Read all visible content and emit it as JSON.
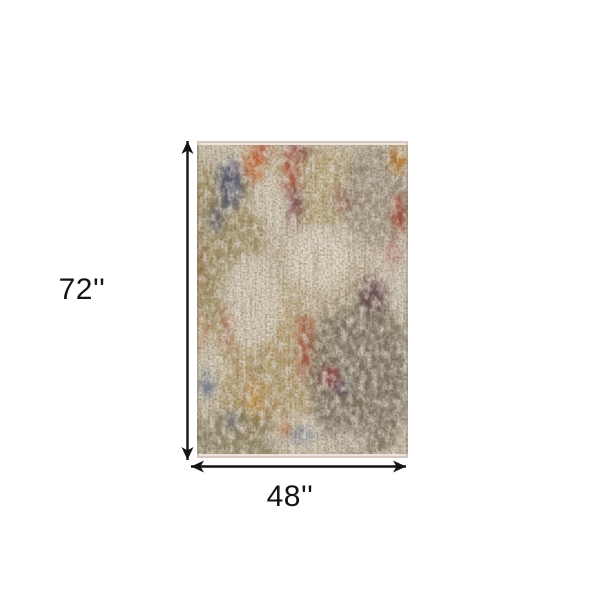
{
  "diagram": {
    "type": "product-dimension-diagram",
    "height_label": "72''",
    "width_label": "48''",
    "arrow_color": "#141414",
    "label_color": "#141414",
    "background_color": "#ffffff"
  },
  "rug": {
    "description": "abstract-distressed-multicolor-area-rug",
    "base_color": "#cfc3ad",
    "fringe_color": "#efe2dc",
    "edge_shade_color": "#5a503c",
    "blobs": [
      {
        "x": 28,
        "y": 100,
        "rx": 40,
        "ry": 95,
        "c": "#9c8a58",
        "o": 0.75
      },
      {
        "x": 70,
        "y": 215,
        "rx": 55,
        "ry": 85,
        "c": "#b89c68",
        "o": 0.75
      },
      {
        "x": 118,
        "y": 45,
        "rx": 50,
        "ry": 40,
        "c": "#bda775",
        "o": 0.7
      },
      {
        "x": 162,
        "y": 235,
        "rx": 50,
        "ry": 90,
        "c": "#7a7160",
        "o": 0.85
      },
      {
        "x": 182,
        "y": 55,
        "rx": 38,
        "ry": 50,
        "c": "#94897a",
        "o": 0.65
      },
      {
        "x": 40,
        "y": 298,
        "rx": 48,
        "ry": 28,
        "c": "#867a58",
        "o": 0.7
      },
      {
        "x": 120,
        "y": 135,
        "rx": 48,
        "ry": 42,
        "c": "#cabb9b",
        "o": 0.75
      },
      {
        "x": 55,
        "y": 160,
        "rx": 30,
        "ry": 48,
        "c": "#e3dccc",
        "o": 0.85
      },
      {
        "x": 122,
        "y": 118,
        "rx": 32,
        "ry": 30,
        "c": "#e6dfd0",
        "o": 0.85
      },
      {
        "x": 34,
        "y": 18,
        "rx": 24,
        "ry": 15,
        "c": "#ddd6c6",
        "o": 0.85
      },
      {
        "x": 76,
        "y": 58,
        "rx": 24,
        "ry": 26,
        "c": "#ded7c5",
        "o": 0.8
      },
      {
        "x": 100,
        "y": 292,
        "rx": 28,
        "ry": 18,
        "c": "#ded7c7",
        "o": 0.8
      },
      {
        "x": 201,
        "y": 135,
        "rx": 16,
        "ry": 38,
        "c": "#d9d3c5",
        "o": 0.8
      },
      {
        "x": 150,
        "y": 303,
        "rx": 24,
        "ry": 13,
        "c": "#d9d2c2",
        "o": 0.75
      },
      {
        "x": 14,
        "y": 225,
        "rx": 14,
        "ry": 30,
        "c": "#dcd5c5",
        "o": 0.7
      },
      {
        "x": 33,
        "y": 44,
        "rx": 13,
        "ry": 26,
        "c": "#46527a",
        "o": 0.8
      },
      {
        "x": 19,
        "y": 78,
        "rx": 8,
        "ry": 14,
        "c": "#3e4b73",
        "o": 0.65
      },
      {
        "x": 56,
        "y": 24,
        "rx": 10,
        "ry": 18,
        "c": "#cf5a1e",
        "o": 0.85
      },
      {
        "x": 67,
        "y": 10,
        "rx": 7,
        "ry": 9,
        "c": "#c2401f",
        "o": 0.8
      },
      {
        "x": 94,
        "y": 30,
        "rx": 7,
        "ry": 25,
        "c": "#a93326",
        "o": 0.8
      },
      {
        "x": 98,
        "y": 63,
        "rx": 8,
        "ry": 19,
        "c": "#6d3040",
        "o": 0.75
      },
      {
        "x": 104,
        "y": 11,
        "rx": 9,
        "ry": 8,
        "c": "#7c2e33",
        "o": 0.7
      },
      {
        "x": 146,
        "y": 58,
        "rx": 6,
        "ry": 11,
        "c": "#7e2d34",
        "o": 0.65
      },
      {
        "x": 201,
        "y": 20,
        "rx": 8,
        "ry": 14,
        "c": "#cc7d20",
        "o": 0.85
      },
      {
        "x": 202,
        "y": 73,
        "rx": 8,
        "ry": 20,
        "c": "#ab3224",
        "o": 0.8
      },
      {
        "x": 196,
        "y": 112,
        "rx": 6,
        "ry": 13,
        "c": "#b0392a",
        "o": 0.55
      },
      {
        "x": 176,
        "y": 152,
        "rx": 15,
        "ry": 18,
        "c": "#5c3346",
        "o": 0.7
      },
      {
        "x": 108,
        "y": 205,
        "rx": 6,
        "ry": 33,
        "c": "#a93224",
        "o": 0.75
      },
      {
        "x": 30,
        "y": 185,
        "rx": 4,
        "ry": 24,
        "c": "#a33524",
        "o": 0.55
      },
      {
        "x": 133,
        "y": 236,
        "rx": 9,
        "ry": 12,
        "c": "#9c2f3a",
        "o": 0.75
      },
      {
        "x": 143,
        "y": 247,
        "rx": 8,
        "ry": 9,
        "c": "#4f3e62",
        "o": 0.65
      },
      {
        "x": 58,
        "y": 258,
        "rx": 7,
        "ry": 17,
        "c": "#cb8628",
        "o": 0.8
      },
      {
        "x": 10,
        "y": 243,
        "rx": 7,
        "ry": 13,
        "c": "#47588a",
        "o": 0.75
      },
      {
        "x": 35,
        "y": 279,
        "rx": 6,
        "ry": 8,
        "c": "#4d5f96",
        "o": 0.7
      },
      {
        "x": 103,
        "y": 294,
        "rx": 13,
        "ry": 6,
        "c": "#47608f",
        "o": 0.75
      },
      {
        "x": 88,
        "y": 288,
        "rx": 8,
        "ry": 6,
        "c": "#cb6a27",
        "o": 0.75
      },
      {
        "x": 6,
        "y": 125,
        "rx": 5,
        "ry": 26,
        "c": "#8a4a28",
        "o": 0.45
      },
      {
        "x": 5,
        "y": 192,
        "rx": 5,
        "ry": 20,
        "c": "#c06a2c",
        "o": 0.5
      }
    ]
  }
}
